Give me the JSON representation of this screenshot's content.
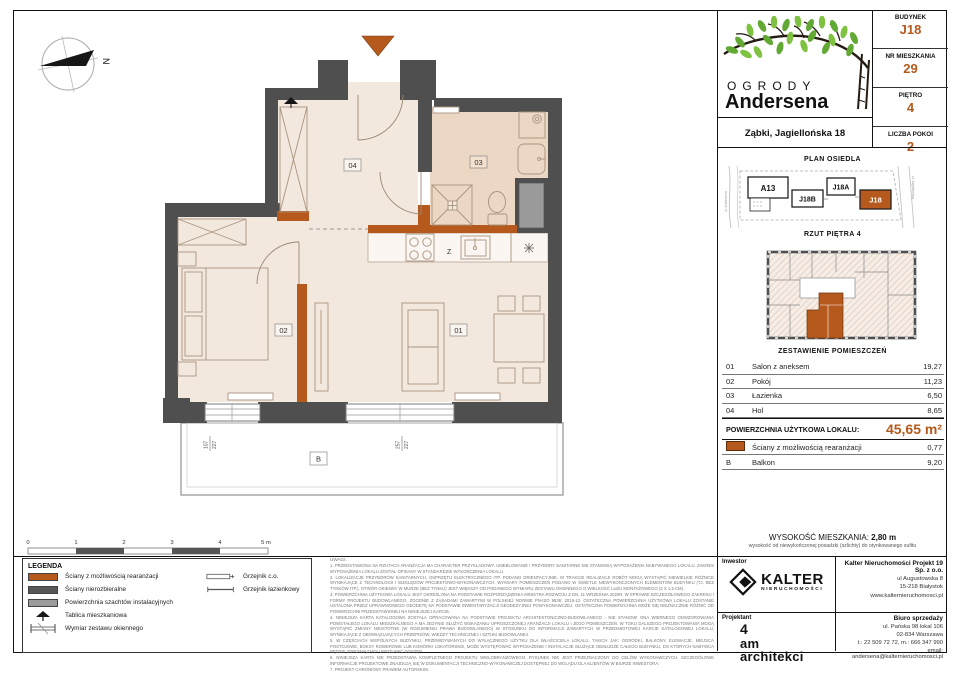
{
  "header": {
    "logo_line1": "OGRODY",
    "logo_line2": "Andersena",
    "address": "Ząbki, Jagiellońska 18"
  },
  "unit_info": [
    {
      "label": "BUDYNEK",
      "value": "J18"
    },
    {
      "label": "NR MIESZKANIA",
      "value": "29"
    },
    {
      "label": "PIĘTRO",
      "value": "4"
    },
    {
      "label": "LICZBA POKOI",
      "value": "2"
    }
  ],
  "site_plan": {
    "title": "PLAN OSIEDLA",
    "buildings": [
      {
        "label": "A13"
      },
      {
        "label": "J18B"
      },
      {
        "label": "J18A"
      },
      {
        "label": "J18",
        "highlighted": true
      }
    ],
    "street_left": "ul. Andersena",
    "street_right": "ul. Jagiellońska"
  },
  "floor_overview": {
    "title": "RZUT PIĘTRA 4"
  },
  "rooms_table": {
    "title": "ZESTAWIENIE POMIESZCZEŃ",
    "rows": [
      {
        "no": "01",
        "name": "Salon z aneksem",
        "area": "19,27"
      },
      {
        "no": "02",
        "name": "Pokój",
        "area": "11,23"
      },
      {
        "no": "03",
        "name": "Łazienka",
        "area": "6,50"
      },
      {
        "no": "04",
        "name": "Hol",
        "area": "8,65"
      }
    ],
    "total_label": "POWIERZCHNIA UŻYTKOWA LOKALU:",
    "total_value": "45,65 m²",
    "extra_wall": {
      "name": "Ściany z możliwością rearanżacji",
      "area": "0,77"
    },
    "balcony": {
      "no": "B",
      "name": "Balkon",
      "area": "9,20"
    }
  },
  "height_info": {
    "label": "WYSOKOŚĆ MIESZKANIA:",
    "value": "2,80 m",
    "note": "wysokość od niewykończonej posadzki (szlichty) do otynkowanego sufitu"
  },
  "investor": {
    "section_label": "Inwestor",
    "brand": "KALTER",
    "brand_sub": "NIERUCHOMOŚCI",
    "company": "Kalter Nieruchomości Projekt 19 Sp. z o.o.",
    "address_lines": [
      "ul Augustowska 8",
      "15-218 Białystok",
      "www.kalternieruchomosci.pl"
    ]
  },
  "designer": {
    "section_label": "Projektant",
    "name_lines": [
      "4",
      "am",
      "architekci"
    ]
  },
  "sales_office": {
    "title": "Biuro sprzedaży",
    "lines": [
      "ul. Pańska 98 lokal 106",
      "02-834 Warszawa",
      "t.: 22 509 72 72, m.: 666 347 990",
      "email: andersena@kalternieruchomosci.pl"
    ]
  },
  "legend": {
    "title": "LEGENDA",
    "items": [
      {
        "label": "Ściany z możliwością rearanżacji",
        "swatch": "orange"
      },
      {
        "label": "Ściany nierozbieralne",
        "swatch": "dark"
      },
      {
        "label": "Powierzchnia szachtów instalacyjnych",
        "swatch": "gray"
      },
      {
        "label": "Tablica mieszkaniowa",
        "swatch": "tablica-icon"
      },
      {
        "label": "Wymiar zestawu okiennego",
        "swatch": "window-dim-icon"
      }
    ],
    "radiators": [
      {
        "label": "Grzejnik c.o."
      },
      {
        "label": "Grzejnik łazienkowy"
      }
    ]
  },
  "scale_bar": {
    "ticks": [
      "0",
      "1",
      "2",
      "3",
      "4",
      "5 m"
    ]
  },
  "plan": {
    "room_labels": {
      "r01": "01",
      "r02": "02",
      "r03": "03",
      "r04": "04"
    },
    "balcony_label": "B",
    "kitchen_z": "Z",
    "compass": "N",
    "window_dims": [
      {
        "w": "107",
        "h": "227"
      },
      {
        "w": "257",
        "h": "227"
      }
    ]
  },
  "notes": {
    "title": "UWAGI:",
    "items": [
      "1.  PRZEDSTAWIONA NA RZUTACH ARANŻACJA MA CHARAKTER PRZYKŁADOWY. UMEBLOWANIE I PRZYBORY SANITARNE NIE STANOWIĄ WYPOSAŻENIA NABYWANEGO LOKALU. ZAKRES WYPOSAŻENIA LOKALU ZOSTAŁ OPISANY W STANDARDZIE WYKOŃCZENIA LOKALU.",
      "2.  LOKALIZACJE PRZYBORÓW SANITARNYCH, OSPRZĘTU ELEKTRYCZNEGO ITP. PODANO ORIENTACYJNIE. W TRAKCIE REALIZACJI ROBÓT MOGĄ WYSTĄPIĆ NIEWIELKIE RÓŻNICE WYNIKAJĄCE Z TECHNOLOGII I WZGLĘDÓW PROJEKTOWO-WYKONAWCZYCH. WYMIARY POMIESZCZEŃ PODANO W ŚWIETLE NIEWYKOŃCZONYCH ELEMENTÓW BUDYNKU (TJ. BEZ TYNKÓW ITP.). OTWÓR OKIENNY W MURZE (BEZ TYNKU) JEST WIĘKSZY OD PODANEGO WYMIARU ZESTAWU OKIENNEGO O WIELKOŚĆ LUZU MONTAŻOWEGO (2 X 1,5 CM).",
      "3.  POWIERZCHNIA UŻYTKOWA LOKALU JEST OKREŚLONA NA PODSTAWIE ROZPORZĄDZENIA MINISTRA ROZWOJU Z DN. 11 WRZEŚNIA 2020R. W SPRAWIE SZCZEGÓŁOWEGO ZAKRESU I FORMY PROJEKTU BUDOWLANEGO, ZGODNIE Z ZASADAMI ZAWARTYMI W POLSKIEJ NORMIE PN-ISO 9836: 2015-12. OSTATECZNA POWIERZCHNIA UŻYTKOWA LOKALU ZOSTANIE USTALONA PRZEZ UPRAWNIONEGO GEODETĘ NA PODSTAWIE INWENTARYZACJI GEODEZYJNEJ POWYKONAWCZEJ. OSTATECZNA POWIERZCHNIA MOŻE SIĘ NIEZNACZNIE RÓŻNIĆ OD POWIERZCHNI PRZEDSTAWIONEJ NA NINIEJSZEJ KARCIE.",
      "4.  NINIEJSZA KARTA KATALOGOWA ZOSTAŁA OPRACOWANA NA PODSTAWIE PROJEKTU ARCHITEKTONICZNO-BUDOWLANEGO - NIE STANOWI ONA WIERNEGO ODWZOROWANIA POWSTAŁEGO LOKALU MIESZKALNEGO A MA JEDYNIE SŁUŻYĆ WSKAZANIU UPROSZCZONEJ ARANŻACJI LOKALU I JEGO POMIESZCZEŃ. W TOKU DALSZEGO PROJEKTOWANIA MOGĄ WYSTĄPIĆ ZMIANY NIEISTOTNE (W ROZUMIENIU PRAWA BUDOWLANEGO) W STOSUNKU DO INFORMACJI ZAWARTYCH W PRZEDMIOTOWEJ KARCIE KATALOGOWEJ LOKALU, WYNIKAJĄCE Z OBOWIĄZUJĄCYCH PRZEPISÓW, WIEDZY TECHNICZNEJ I SZTUKI BUDOWLANEJ.",
      "5.  W CZĘŚCIACH WSPÓLNYCH BUDYNKU, PRZEWIDYWANYCH DO WYŁĄCZNEGO UŻYTKU DLA WŁAŚCICIELA LOKALU, TAKICH JAK: OGRÓDKI, BALKONY, ELEWACJE, MIEJSCA POSTOJOWE, BOKSY ROWEROWE LUB KOMÓRKI LOKATORSKIE, MOŻE WYSTĘPOWAĆ WYPOSAŻENIE I INSTALACJE SŁUŻĄCE OBSŁUDZE CAŁEGO BUDYNKU, DO KTÓRYCH NABYWCA BĘDZIE ZOBOWIĄZANY UMOŻLIWIĆ DOSTĘP.",
      "6.  NINIEJSZA KARTA NIE PRZEDSTAWIA KOMPLETNEGO PROJEKTU WIELOBRANŻOWEGO. RYSUNEK NIE JEST PRZEZNACZONY DO CELÓW WYKONAWCZYCH. SZCZEGÓŁOWE INFORMACJE PROJEKTOWE ZNAJDUJĄ SIĘ W DOKUMENTACJI TECHNICZNO-WYKONAWCZEJ DOSTĘPNEJ DO WGLĄDU DLA KLIENTÓW W BIURZE INWESTORA.",
      "7.  PROJEKT CHRONIONY PRAWEM AUTORSKIM."
    ]
  },
  "colors": {
    "accent": "#b5591c",
    "wall": "#4f4f4f",
    "room_fill": "#f3e8de",
    "bath_fill": "#ecd7c4",
    "shaft": "#9a9a9a",
    "leaf_green": "#61a933"
  }
}
